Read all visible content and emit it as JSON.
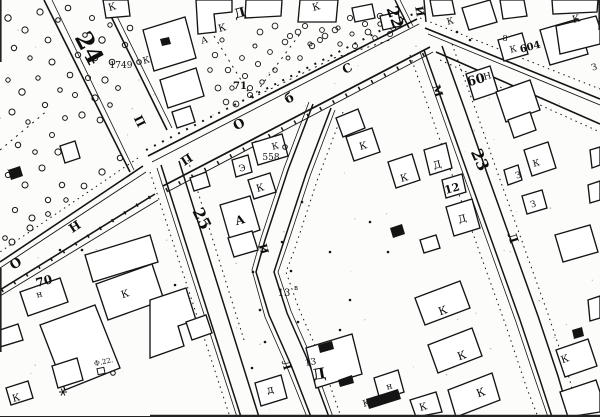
{
  "map": {
    "description": "Scanned black-and-white city cadastral plan with Cyrillic annotations",
    "background_color": "#fcfcfa",
    "ink_color": "#141414",
    "block_numbers": [
      "24",
      "22",
      "23",
      "25",
      "12",
      "13",
      "60",
      "604",
      "70",
      "71"
    ],
    "address_numbers": [
      "1749",
      "558",
      "13в",
      "Ф.22.",
      "8"
    ],
    "street_letters": [
      "П",
      "Н",
      "О",
      "б",
      "С",
      "И",
      "М",
      "Л"
    ],
    "building_letters": [
      "К",
      "Д",
      "А",
      "Э",
      "З",
      "Н",
      "д",
      "н"
    ],
    "labels": [
      {
        "text": "24",
        "x": 82,
        "y": 52,
        "rot": 62,
        "size": 24,
        "bold": 1
      },
      {
        "text": "22",
        "x": 390,
        "y": 19,
        "rot": 70,
        "size": 16,
        "bold": 1
      },
      {
        "text": "23",
        "x": 475,
        "y": 162,
        "rot": 66,
        "size": 16,
        "bold": 1
      },
      {
        "text": "25",
        "x": 197,
        "y": 221,
        "rot": 64,
        "size": 16,
        "bold": 1
      },
      {
        "text": "12",
        "x": 453,
        "y": 192,
        "rot": -15,
        "size": 11,
        "bold": 1
      },
      {
        "text": "70",
        "x": 45,
        "y": 285,
        "rot": -15,
        "size": 12,
        "bold": 1
      },
      {
        "text": "71",
        "x": 240,
        "y": 89,
        "rot": 0,
        "size": 10,
        "bold": 1
      },
      {
        "text": "1749",
        "x": 121,
        "y": 68,
        "rot": 0,
        "size": 9,
        "bold": 0
      },
      {
        "text": "558",
        "x": 271,
        "y": 160,
        "rot": 0,
        "size": 9,
        "bold": 0
      },
      {
        "text": "60",
        "x": 477,
        "y": 84,
        "rot": -15,
        "size": 13,
        "bold": 1
      },
      {
        "text": "604",
        "x": 531,
        "y": 50,
        "rot": -15,
        "size": 10,
        "bold": 1
      },
      {
        "text": "13",
        "x": 284,
        "y": 296,
        "rot": 0,
        "size": 10,
        "bold": 0
      },
      {
        "text": "в",
        "x": 296,
        "y": 290,
        "rot": 0,
        "size": 7,
        "bold": 0
      },
      {
        "text": "13",
        "x": 311,
        "y": 365,
        "rot": -10,
        "size": 9,
        "bold": 0
      },
      {
        "text": "Д",
        "x": 320,
        "y": 379,
        "rot": -10,
        "size": 15,
        "bold": 1
      },
      {
        "text": "Ф.22.",
        "x": 104,
        "y": 364,
        "rot": -12,
        "size": 7,
        "bold": 0
      },
      {
        "text": "8",
        "x": 505,
        "y": 41,
        "rot": 0,
        "size": 8,
        "bold": 0
      },
      {
        "text": "П",
        "x": 136,
        "y": 123,
        "rot": 64,
        "size": 12,
        "bold": 1
      },
      {
        "text": "П",
        "x": 189,
        "y": 163,
        "rot": -33,
        "size": 12,
        "bold": 1
      },
      {
        "text": "Н",
        "x": 77,
        "y": 230,
        "rot": -33,
        "size": 12,
        "bold": 1
      },
      {
        "text": "О",
        "x": 18,
        "y": 267,
        "rot": -33,
        "size": 13,
        "bold": 1
      },
      {
        "text": "О",
        "x": 241,
        "y": 128,
        "rot": -28,
        "size": 13,
        "bold": 1
      },
      {
        "text": "б",
        "x": 291,
        "y": 102,
        "rot": -26,
        "size": 13,
        "bold": 1
      },
      {
        "text": "С",
        "x": 349,
        "y": 72,
        "rot": -26,
        "size": 12,
        "bold": 1
      },
      {
        "text": "И",
        "x": 416,
        "y": 12,
        "rot": 80,
        "size": 11,
        "bold": 1
      },
      {
        "text": "М",
        "x": 434,
        "y": 92,
        "rot": 72,
        "size": 11,
        "bold": 1
      },
      {
        "text": "Л",
        "x": 509,
        "y": 239,
        "rot": 72,
        "size": 12,
        "bold": 1
      },
      {
        "text": "И",
        "x": 260,
        "y": 250,
        "rot": 74,
        "size": 11,
        "bold": 1
      },
      {
        "text": "Л",
        "x": 283,
        "y": 366,
        "rot": 74,
        "size": 11,
        "bold": 1
      },
      {
        "text": "К",
        "x": 113,
        "y": 10,
        "rot": -15,
        "size": 10,
        "bold": 0
      },
      {
        "text": "К",
        "x": 147,
        "y": 63,
        "rot": -15,
        "size": 9,
        "bold": 0
      },
      {
        "text": "Д",
        "x": 241,
        "y": 17,
        "rot": -15,
        "size": 13,
        "bold": 1
      },
      {
        "text": "К",
        "x": 223,
        "y": 31,
        "rot": -15,
        "size": 10,
        "bold": 0
      },
      {
        "text": "А",
        "x": 205,
        "y": 43,
        "rot": -15,
        "size": 9,
        "bold": 0
      },
      {
        "text": "К",
        "x": 317,
        "y": 10,
        "rot": -15,
        "size": 10,
        "bold": 0
      },
      {
        "text": "К",
        "x": 451,
        "y": 24,
        "rot": -15,
        "size": 9,
        "bold": 0
      },
      {
        "text": "К",
        "x": 577,
        "y": 22,
        "rot": -15,
        "size": 10,
        "bold": 0
      },
      {
        "text": "К",
        "x": 514,
        "y": 52,
        "rot": -15,
        "size": 9,
        "bold": 0
      },
      {
        "text": "Н",
        "x": 488,
        "y": 79,
        "rot": -15,
        "size": 9,
        "bold": 0
      },
      {
        "text": "К",
        "x": 537,
        "y": 166,
        "rot": -15,
        "size": 9,
        "bold": 0
      },
      {
        "text": "З",
        "x": 519,
        "y": 178,
        "rot": -15,
        "size": 9,
        "bold": 0
      },
      {
        "text": "З",
        "x": 534,
        "y": 207,
        "rot": -15,
        "size": 9,
        "bold": 0
      },
      {
        "text": "З",
        "x": 595,
        "y": 70,
        "rot": -15,
        "size": 9,
        "bold": 0
      },
      {
        "text": "К",
        "x": 364,
        "y": 149,
        "rot": -15,
        "size": 10,
        "bold": 0
      },
      {
        "text": "К",
        "x": 405,
        "y": 181,
        "rot": -15,
        "size": 10,
        "bold": 0
      },
      {
        "text": "Д",
        "x": 438,
        "y": 168,
        "rot": -15,
        "size": 10,
        "bold": 0
      },
      {
        "text": "Д",
        "x": 463,
        "y": 222,
        "rot": -15,
        "size": 10,
        "bold": 0
      },
      {
        "text": "Э",
        "x": 243,
        "y": 171,
        "rot": -15,
        "size": 9,
        "bold": 0
      },
      {
        "text": "К",
        "x": 261,
        "y": 191,
        "rot": -15,
        "size": 10,
        "bold": 0
      },
      {
        "text": "К",
        "x": 276,
        "y": 149,
        "rot": -15,
        "size": 9,
        "bold": 0
      },
      {
        "text": "А",
        "x": 241,
        "y": 224,
        "rot": -15,
        "size": 12,
        "bold": 1
      },
      {
        "text": "К",
        "x": 126,
        "y": 297,
        "rot": -18,
        "size": 10,
        "bold": 0
      },
      {
        "text": "н",
        "x": 40,
        "y": 297,
        "rot": -15,
        "size": 9,
        "bold": 0
      },
      {
        "text": "К",
        "x": 17,
        "y": 401,
        "rot": -15,
        "size": 10,
        "bold": 0
      },
      {
        "text": "д",
        "x": 271,
        "y": 393,
        "rot": -12,
        "size": 11,
        "bold": 0
      },
      {
        "text": "н",
        "x": 390,
        "y": 389,
        "rot": -15,
        "size": 9,
        "bold": 0
      },
      {
        "text": "К",
        "x": 367,
        "y": 406,
        "rot": -15,
        "size": 9,
        "bold": 0
      },
      {
        "text": "К",
        "x": 424,
        "y": 410,
        "rot": -15,
        "size": 10,
        "bold": 0
      },
      {
        "text": "К",
        "x": 444,
        "y": 314,
        "rot": -20,
        "size": 11,
        "bold": 0
      },
      {
        "text": "К",
        "x": 463,
        "y": 359,
        "rot": -20,
        "size": 11,
        "bold": 0
      },
      {
        "text": "К",
        "x": 482,
        "y": 396,
        "rot": -20,
        "size": 11,
        "bold": 0
      },
      {
        "text": "К",
        "x": 566,
        "y": 362,
        "rot": -20,
        "size": 10,
        "bold": 0
      }
    ],
    "symbols": [
      {
        "type": "star-marker",
        "x": 63,
        "y": 392
      },
      {
        "type": "circle-marker",
        "x": 285,
        "y": 147
      },
      {
        "type": "circle-marker",
        "x": 139,
        "y": 62
      },
      {
        "type": "square-marker",
        "x": 101,
        "y": 371
      },
      {
        "type": "circle-marker",
        "x": 113,
        "y": 373
      }
    ]
  }
}
